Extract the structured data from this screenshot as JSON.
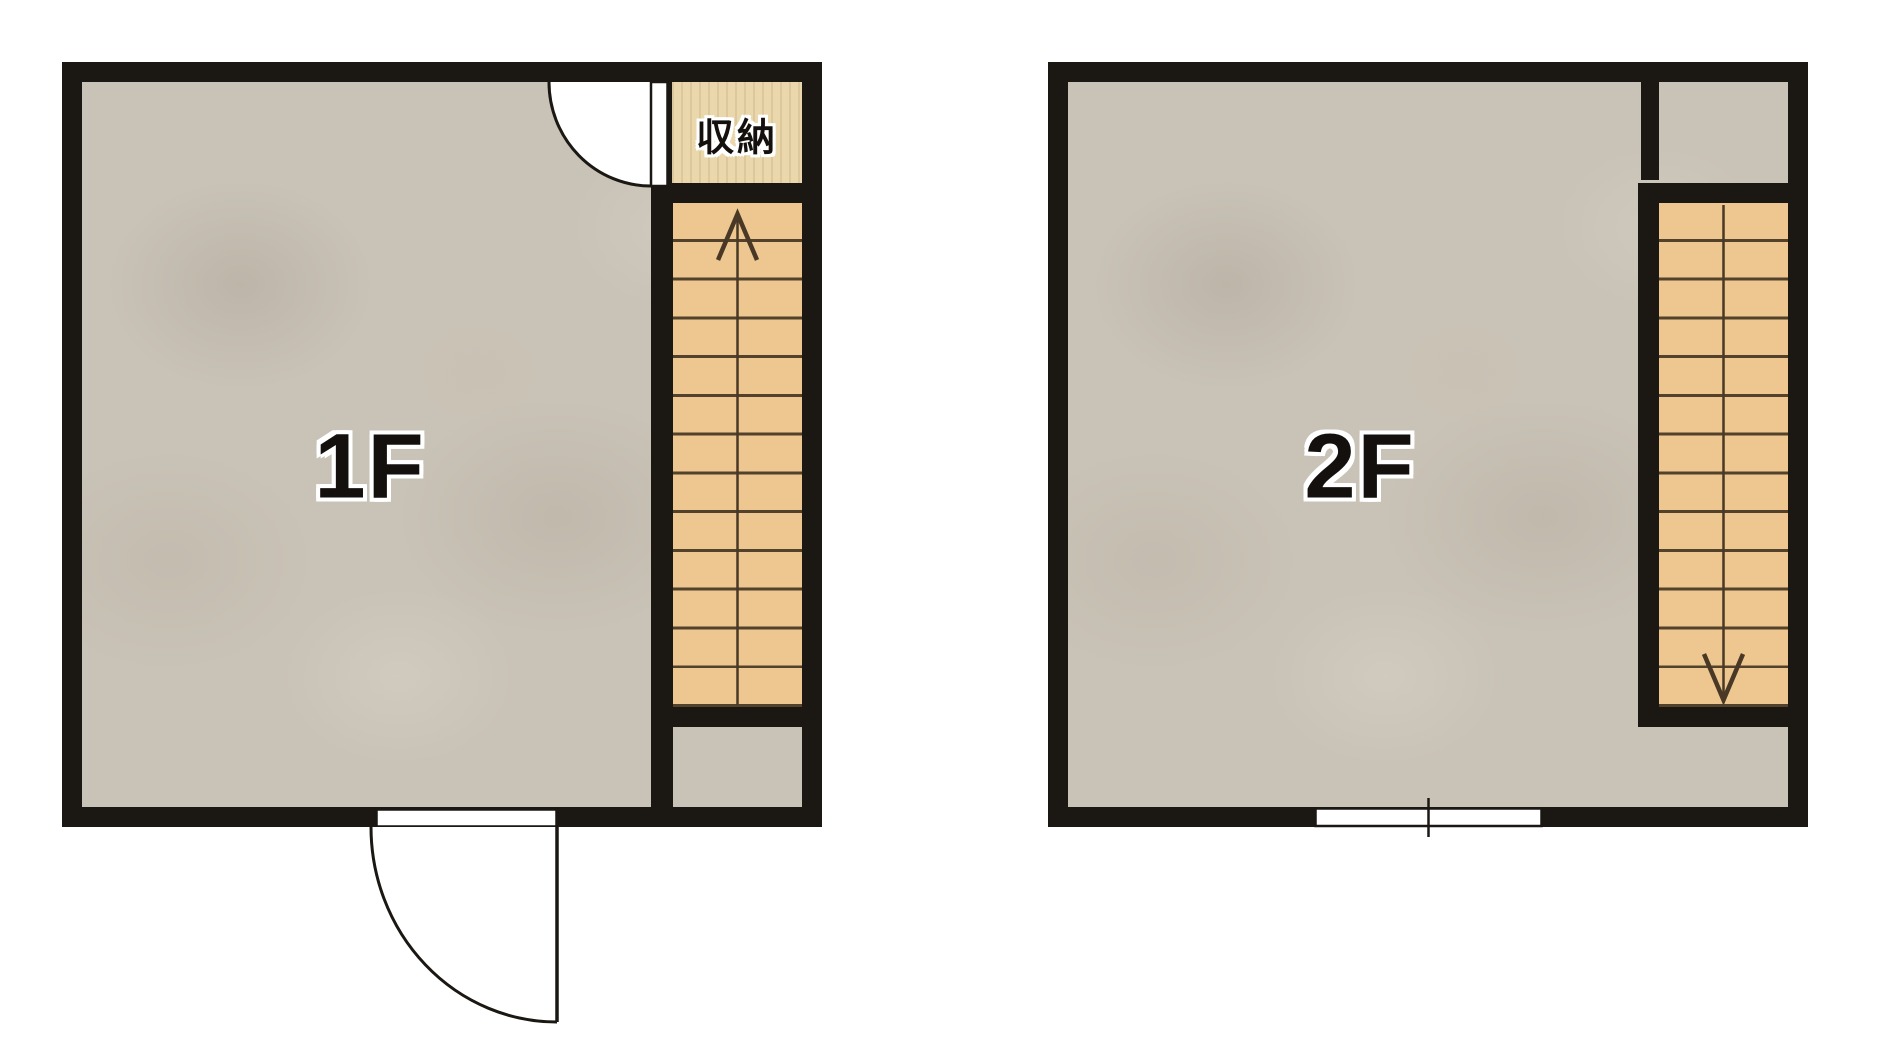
{
  "canvas": {
    "width": 1888,
    "height": 1048,
    "background": "#ffffff"
  },
  "palette": {
    "wall": "#1b1713",
    "floor_gray": "#c9c2b6",
    "stair_fill": "#edc78f",
    "storage_fill": "#ead8ac",
    "tread_line": "#53422b",
    "arrow": "#4a3826",
    "door_fill": "#ffffff",
    "outline_black": "#1b1713"
  },
  "floors": [
    {
      "label": "1F",
      "storage_label": "収納",
      "stair": {
        "treads": 13,
        "orientation": "vertical",
        "arrow_direction": "up"
      },
      "doors": [
        {
          "name": "interior-door-top-right",
          "symbol": "quarter-arc-swing",
          "swing": "into-room"
        },
        {
          "name": "entry-door-bottom",
          "symbol": "quarter-arc-swing",
          "swing": "outward"
        }
      ]
    },
    {
      "label": "2F",
      "stair": {
        "treads": 13,
        "orientation": "vertical",
        "arrow_direction": "down"
      },
      "window": {
        "name": "sliding-window-bottom",
        "symbol": "rect-with-center-tick"
      }
    }
  ]
}
